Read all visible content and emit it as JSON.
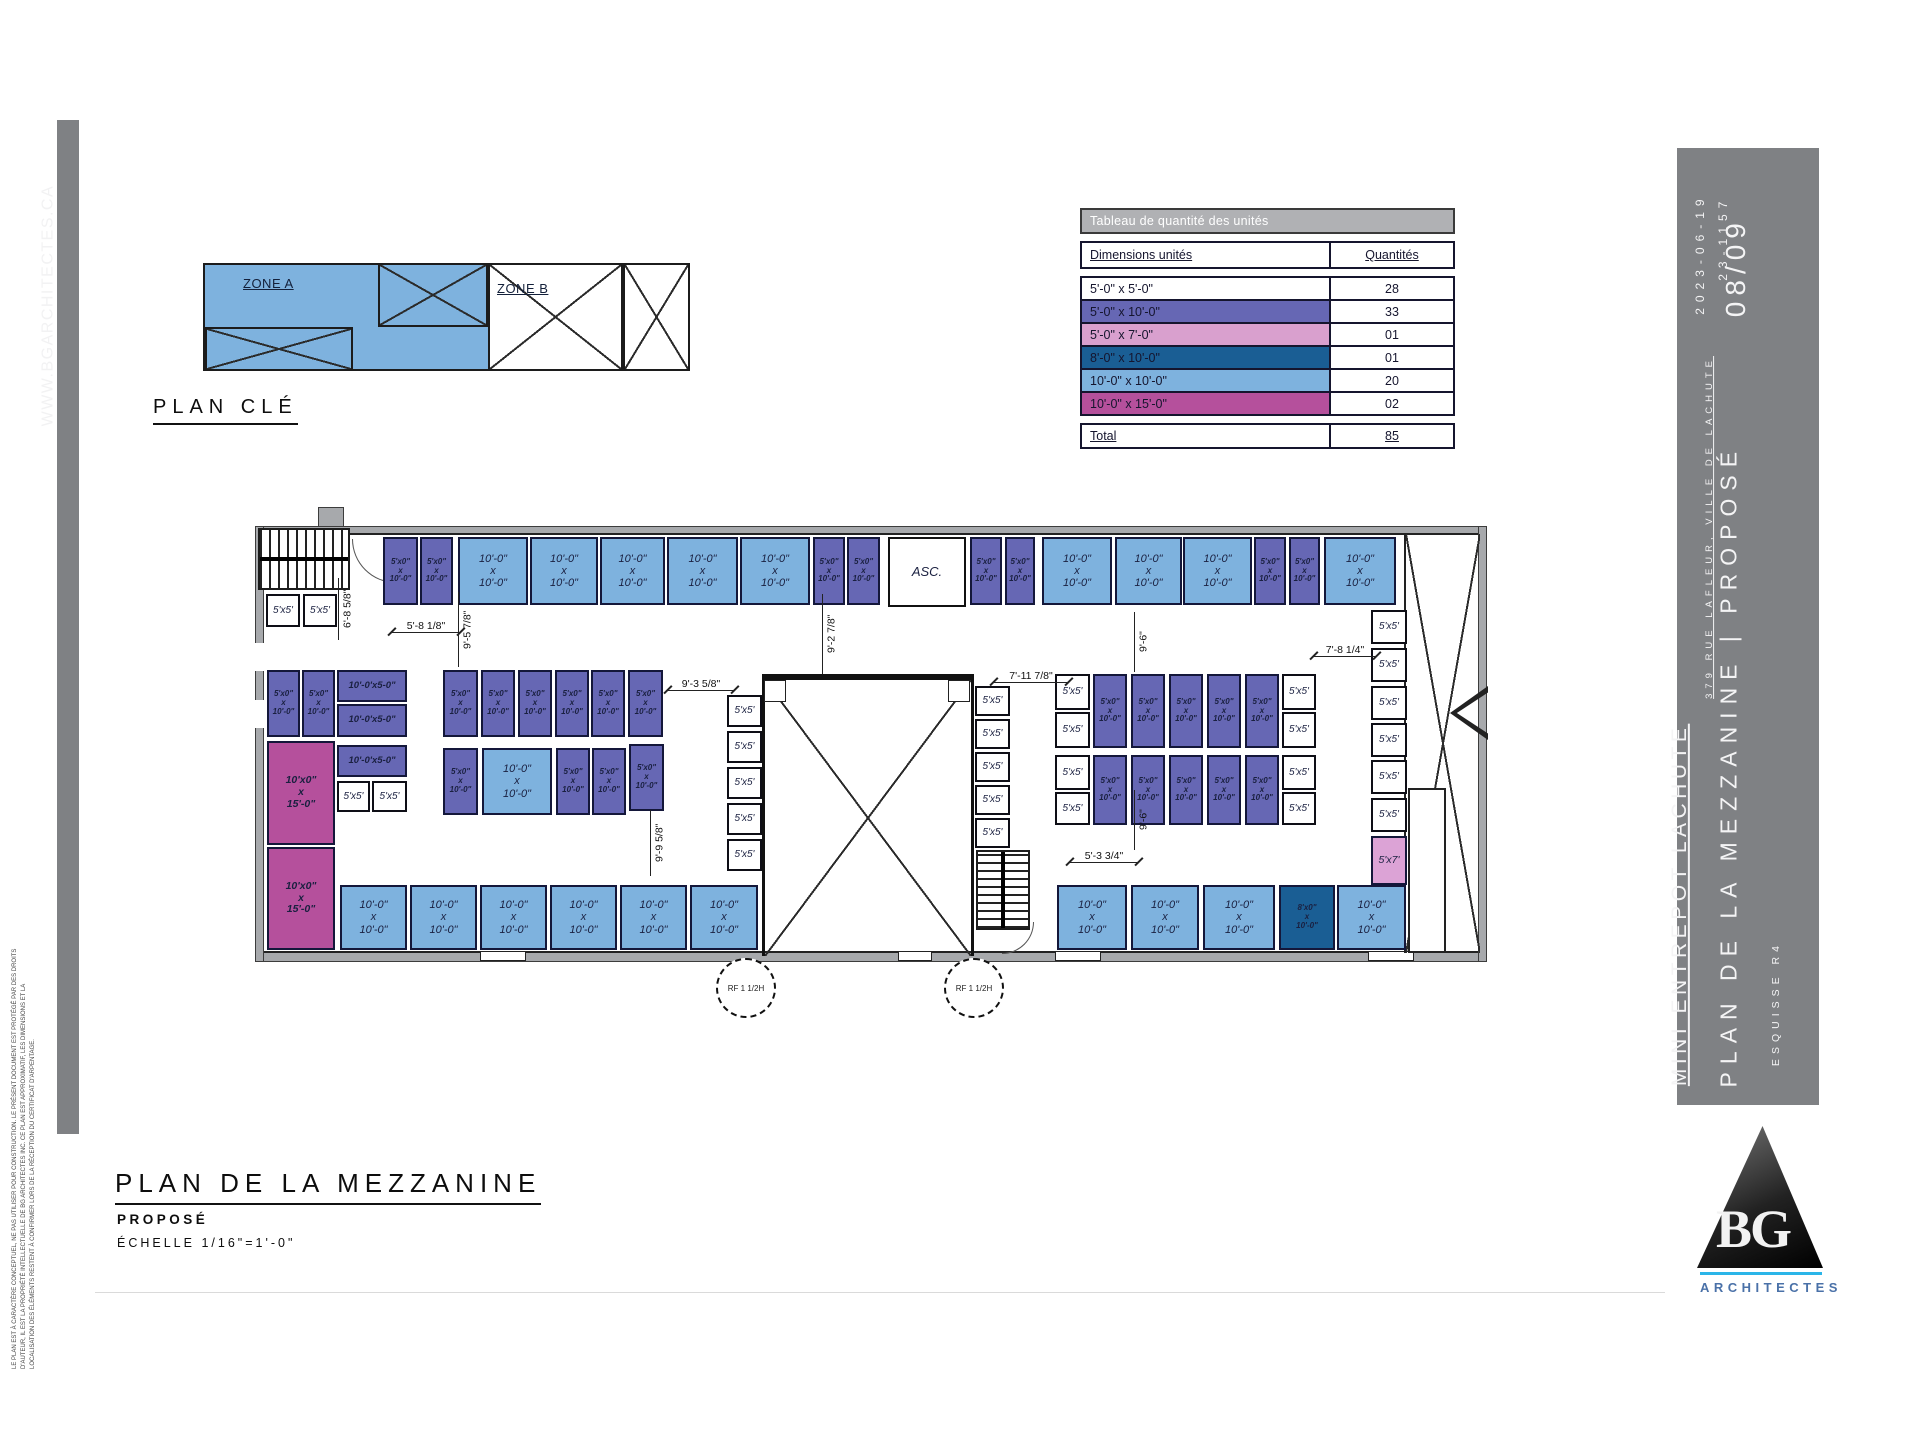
{
  "left_bar": {
    "url": "WWW.BGARCHITECTES.CA",
    "disclaimer": [
      "LE PLAN EST À CARACTÈRE CONCEPTUEL, NE PAS UTILISER POUR CONSTRUCTION. LE PRÉSENT DOCUMENT EST PROTÉGÉ PAR DES DROITS",
      "D'AUTEUR, IL EST LA PROPRIÉTÉ INTELLECTUELLE DE BG ARCHITECTES INC. CE PLAN EST APPROXIMATIF, LES DIMENSIONS ET LA",
      "LOCALISATION DES ÉLÉMENTS RESTENT À CONFIRMER LORS DE LA RÉCEPTION DU CERTIFICAT D'ARPENTAGE."
    ]
  },
  "key_plan": {
    "title": "PLAN CLÉ",
    "zone_a": "ZONE A",
    "zone_b": "ZONE B"
  },
  "table": {
    "title": "Tableau de quantité des unités",
    "col_dim": "Dimensions unités",
    "col_qty": "Quantités",
    "rows": [
      {
        "dim": "5'-0\" x 5'-0\"",
        "qty": "28",
        "color": "#FFFFFF"
      },
      {
        "dim": "5'-0\" x 10'-0\"",
        "qty": "33",
        "color": "#6667B4"
      },
      {
        "dim": "5'-0\" x 7'-0\"",
        "qty": "01",
        "color": "#D9A0CE"
      },
      {
        "dim": "8'-0\" x 10'-0\"",
        "qty": "01",
        "color": "#1A5E94"
      },
      {
        "dim": "10'-0\" x 10'-0\"",
        "qty": "20",
        "color": "#7EB2DE"
      },
      {
        "dim": "10'-0\" x 15'-0\"",
        "qty": "02",
        "color": "#B5509C"
      }
    ],
    "total_label": "Total",
    "total_qty": "85"
  },
  "drawing_title": {
    "title": "PLAN DE LA MEZZANINE",
    "subtitle": "PROPOSÉ",
    "scale": "ÉCHELLE 1/16\"=1'-0\""
  },
  "titleblock": {
    "project": "MINI ENTREPOT LACHUTE",
    "address": "379 RUE LAFLEUR, VILLE DE LACHUTE",
    "sheet_title": "PLAN DE LA MEZZANINE",
    "separator": "|",
    "status": "PROPOSÉ",
    "sketch": "ESQUISSE R4",
    "date": "2023-06-19",
    "project_no": "23-1157",
    "page_no": "08/09",
    "logo_text": "BG",
    "logo_sub": "ARCHITECTES"
  },
  "plan": {
    "colors": {
      "b": "#7EB2DE",
      "p": "#6667B4",
      "w": "#FFFFFF",
      "m": "#B5509C",
      "d": "#1A5E94",
      "k": "#DCA3D6",
      "e": "#FFFFFF"
    },
    "names": {
      "b": "unit-10x10",
      "p": "unit-5x10",
      "w": "unit-5x5",
      "m": "unit-10x15",
      "d": "unit-8x10",
      "k": "unit-5x7",
      "e": "elevator-room"
    },
    "labels": {
      "b": [
        "10'-0\"",
        "x",
        "10'-0\""
      ],
      "p": [
        "5'x0\"",
        "x",
        "10'-0\""
      ],
      "w": [
        "5'x5'"
      ],
      "m": [
        "10'x0\"",
        "x",
        "15'-0\""
      ],
      "d": [
        "8'x0\"",
        "x",
        "10'-0\""
      ],
      "k": [
        "5'x7'"
      ],
      "e": [
        "ASC."
      ]
    },
    "units": [
      [
        383,
        537,
        35,
        68,
        "p"
      ],
      [
        420,
        537,
        33,
        68,
        "p"
      ],
      [
        458,
        537,
        70,
        68,
        "b"
      ],
      [
        530,
        537,
        68,
        68,
        "b"
      ],
      [
        600,
        537,
        65,
        68,
        "b"
      ],
      [
        667,
        537,
        71,
        68,
        "b"
      ],
      [
        740,
        537,
        70,
        68,
        "b"
      ],
      [
        813,
        537,
        32,
        68,
        "p"
      ],
      [
        847,
        537,
        33,
        68,
        "p"
      ],
      [
        888,
        537,
        78,
        70,
        "e"
      ],
      [
        970,
        537,
        32,
        68,
        "p"
      ],
      [
        1005,
        537,
        30,
        68,
        "p"
      ],
      [
        1042,
        537,
        70,
        68,
        "b"
      ],
      [
        1115,
        537,
        67,
        68,
        "b"
      ],
      [
        1183,
        537,
        69,
        68,
        "b"
      ],
      [
        1254,
        537,
        32,
        68,
        "p"
      ],
      [
        1289,
        537,
        31,
        68,
        "p"
      ],
      [
        1324,
        537,
        72,
        68,
        "b"
      ],
      [
        266,
        594,
        34,
        33,
        "w"
      ],
      [
        303,
        594,
        34,
        33,
        "w"
      ],
      [
        267,
        670,
        33,
        67,
        "p"
      ],
      [
        302,
        670,
        33,
        67,
        "p"
      ],
      [
        337,
        670,
        70,
        32,
        "p",
        [
          "10'-0'x5-0\""
        ]
      ],
      [
        337,
        704,
        70,
        33,
        "p",
        [
          "10'-0'x5-0\""
        ]
      ],
      [
        337,
        745,
        70,
        32,
        "p",
        [
          "10'-0'x5-0\""
        ]
      ],
      [
        337,
        781,
        33,
        31,
        "w"
      ],
      [
        372,
        781,
        35,
        31,
        "w"
      ],
      [
        267,
        741,
        68,
        104,
        "m"
      ],
      [
        267,
        847,
        68,
        103,
        "m"
      ],
      [
        443,
        670,
        35,
        67,
        "p"
      ],
      [
        481,
        670,
        34,
        67,
        "p"
      ],
      [
        518,
        670,
        34,
        67,
        "p"
      ],
      [
        555,
        670,
        34,
        67,
        "p"
      ],
      [
        591,
        670,
        34,
        67,
        "p"
      ],
      [
        628,
        670,
        35,
        67,
        "p"
      ],
      [
        443,
        748,
        35,
        67,
        "p"
      ],
      [
        482,
        748,
        70,
        67,
        "b"
      ],
      [
        556,
        748,
        34,
        67,
        "p"
      ],
      [
        592,
        748,
        34,
        67,
        "p"
      ],
      [
        629,
        744,
        35,
        67,
        "p"
      ],
      [
        727,
        695,
        35,
        32,
        "w"
      ],
      [
        727,
        731,
        35,
        32,
        "w"
      ],
      [
        727,
        767,
        35,
        32,
        "w"
      ],
      [
        727,
        803,
        35,
        32,
        "w"
      ],
      [
        727,
        839,
        35,
        32,
        "w"
      ],
      [
        975,
        686,
        35,
        30,
        "w"
      ],
      [
        975,
        719,
        35,
        30,
        "w"
      ],
      [
        975,
        752,
        35,
        30,
        "w"
      ],
      [
        975,
        785,
        35,
        30,
        "w"
      ],
      [
        975,
        818,
        35,
        30,
        "w"
      ],
      [
        1055,
        674,
        35,
        36,
        "w"
      ],
      [
        1055,
        712,
        35,
        36,
        "w"
      ],
      [
        1055,
        755,
        35,
        35,
        "w"
      ],
      [
        1055,
        792,
        35,
        33,
        "w"
      ],
      [
        1093,
        674,
        34,
        74,
        "p"
      ],
      [
        1131,
        674,
        34,
        74,
        "p"
      ],
      [
        1169,
        674,
        34,
        74,
        "p"
      ],
      [
        1207,
        674,
        34,
        74,
        "p"
      ],
      [
        1245,
        674,
        34,
        74,
        "p"
      ],
      [
        1093,
        755,
        34,
        70,
        "p"
      ],
      [
        1131,
        755,
        34,
        70,
        "p"
      ],
      [
        1169,
        755,
        34,
        70,
        "p"
      ],
      [
        1207,
        755,
        34,
        70,
        "p"
      ],
      [
        1245,
        755,
        34,
        70,
        "p"
      ],
      [
        1282,
        674,
        34,
        36,
        "w"
      ],
      [
        1282,
        712,
        34,
        36,
        "w"
      ],
      [
        1282,
        755,
        34,
        35,
        "w"
      ],
      [
        1282,
        792,
        34,
        33,
        "w"
      ],
      [
        1371,
        610,
        36,
        34,
        "w"
      ],
      [
        1371,
        648,
        36,
        34,
        "w"
      ],
      [
        1371,
        686,
        36,
        34,
        "w"
      ],
      [
        1371,
        723,
        36,
        34,
        "w"
      ],
      [
        1371,
        760,
        36,
        34,
        "w"
      ],
      [
        1371,
        798,
        36,
        34,
        "w"
      ],
      [
        1371,
        836,
        36,
        49,
        "k"
      ],
      [
        340,
        885,
        67,
        65,
        "b"
      ],
      [
        410,
        885,
        67,
        65,
        "b"
      ],
      [
        480,
        885,
        67,
        65,
        "b"
      ],
      [
        550,
        885,
        67,
        65,
        "b"
      ],
      [
        620,
        885,
        67,
        65,
        "b"
      ],
      [
        690,
        885,
        68,
        65,
        "b"
      ],
      [
        1057,
        885,
        70,
        65,
        "b"
      ],
      [
        1131,
        885,
        68,
        65,
        "b"
      ],
      [
        1203,
        885,
        72,
        65,
        "b"
      ],
      [
        1279,
        885,
        56,
        65,
        "d"
      ],
      [
        1337,
        885,
        69,
        65,
        "b"
      ]
    ],
    "dims": [
      [
        "6'-8 5/8\"",
        338,
        578,
        62,
        "v"
      ],
      [
        "5'-8 1/8\"",
        392,
        616,
        68,
        "h"
      ],
      [
        "9'-5 7/8\"",
        458,
        592,
        75,
        "v"
      ],
      [
        "9'-2 7/8\"",
        822,
        594,
        80,
        "v"
      ],
      [
        "9'-3 5/8\"",
        668,
        674,
        66,
        "h"
      ],
      [
        "7'-11 7/8\"",
        994,
        666,
        74,
        "h"
      ],
      [
        "9'-6\"",
        1134,
        612,
        60,
        "v"
      ],
      [
        "9'-6\"",
        1134,
        790,
        60,
        "v"
      ],
      [
        "7'-8 1/4\"",
        1314,
        640,
        62,
        "h"
      ],
      [
        "5'-3 3/4\"",
        1070,
        846,
        68,
        "h"
      ],
      [
        "9'-9 5/8\"",
        650,
        810,
        66,
        "v"
      ]
    ],
    "rf": [
      {
        "t": "RF 1 1/2H",
        "x": 716,
        "y": 958
      },
      {
        "t": "RF 1 1/2H",
        "x": 944,
        "y": 958
      }
    ]
  }
}
